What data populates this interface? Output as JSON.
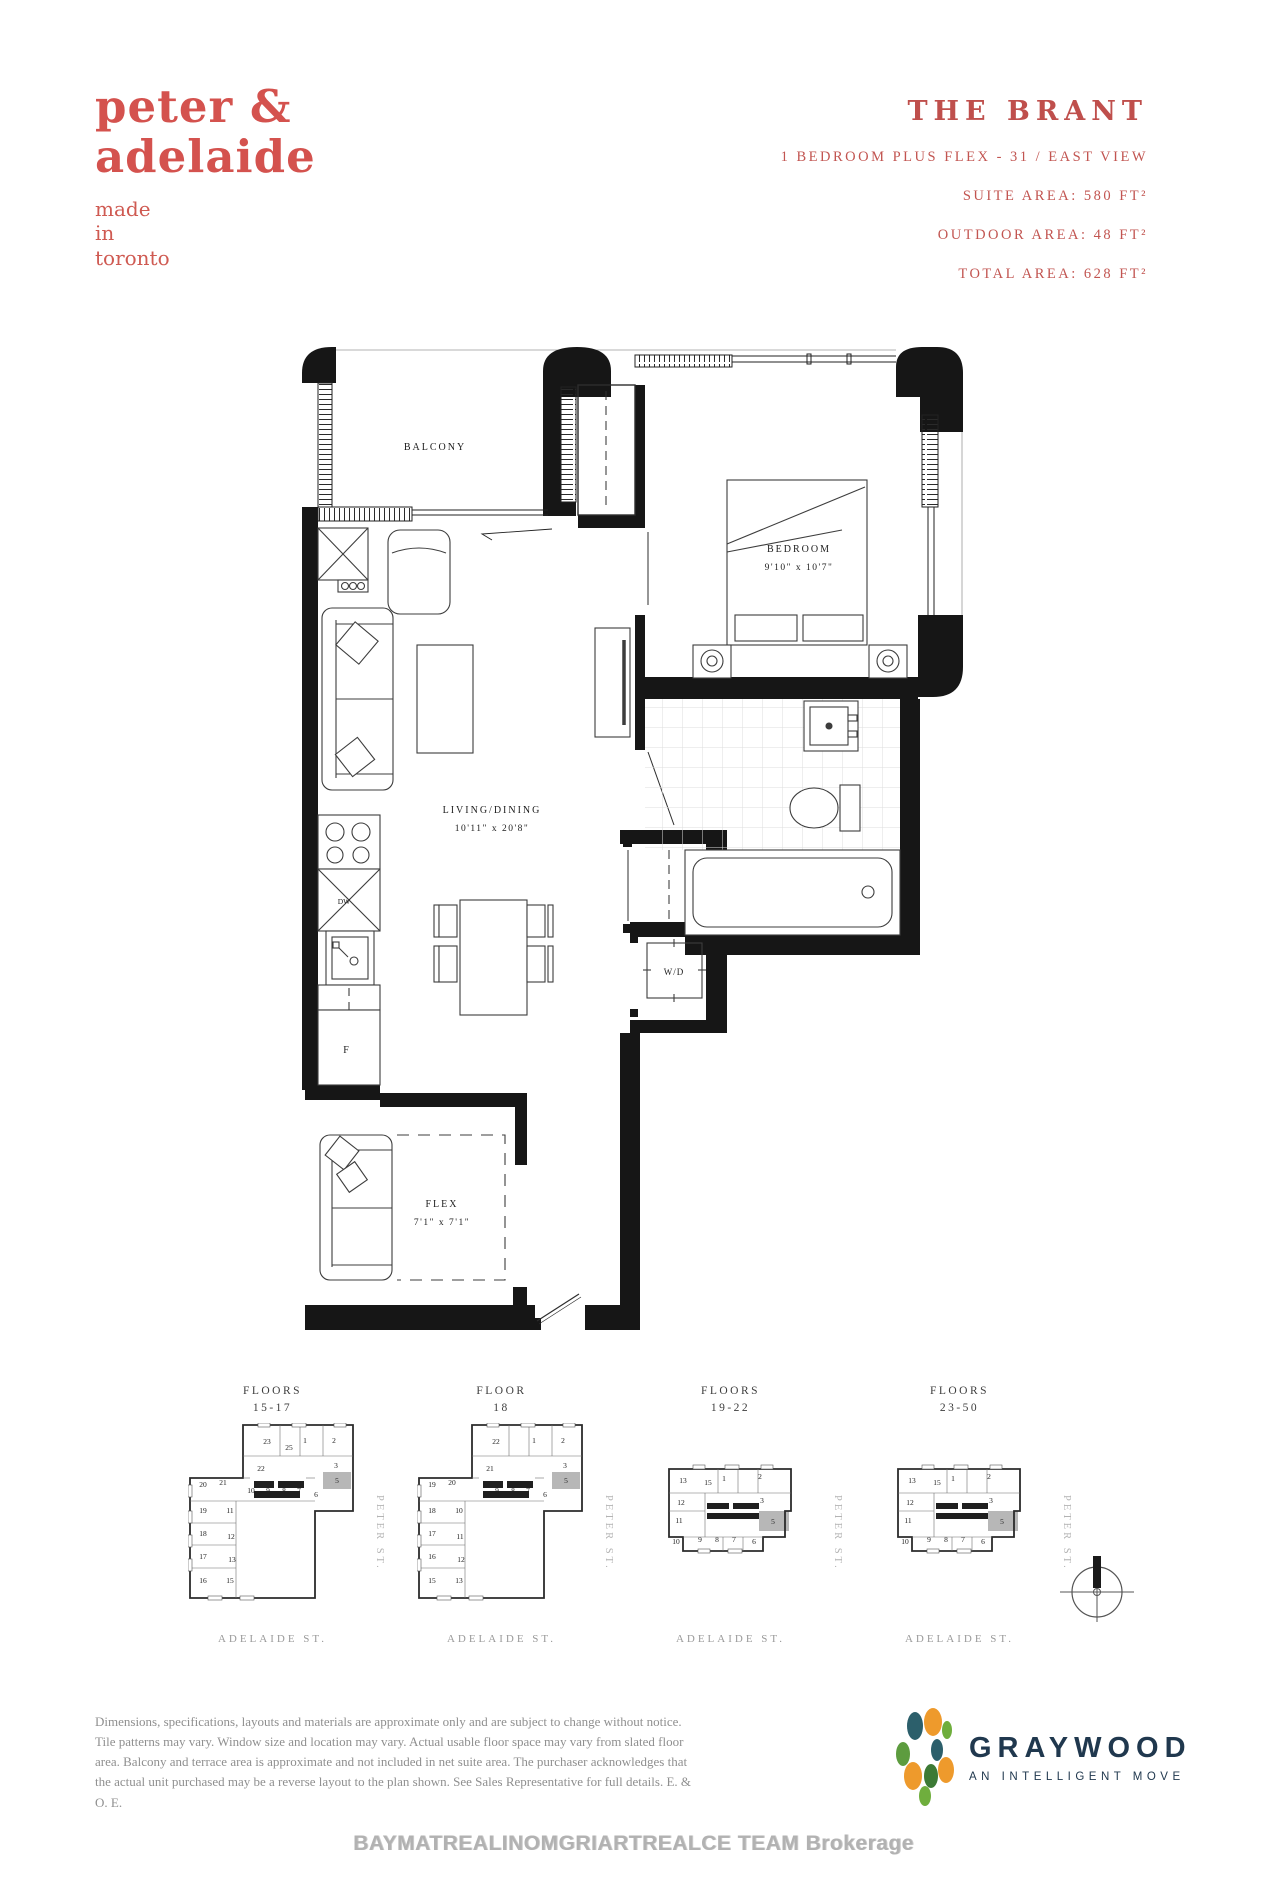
{
  "brand": {
    "logo_line1": "peter &",
    "logo_line2": "adelaide",
    "tagline_lines": [
      "made",
      "in",
      "toronto"
    ]
  },
  "header": {
    "title": "THE BRANT",
    "subtitle": "1 BEDROOM PLUS FLEX - 31 / EAST VIEW",
    "suite_area": "SUITE AREA: 580 FT²",
    "outdoor_area": "OUTDOOR AREA: 48 FT²",
    "total_area": "TOTAL AREA: 628 FT²"
  },
  "floorplan": {
    "labels": {
      "balcony": "BALCONY",
      "bedroom_name": "BEDROOM",
      "bedroom_dims": "9'10\" x 10'7\"",
      "living_name": "LIVING/DINING",
      "living_dims": "10'11\" x 20'8\"",
      "flex_name": "FLEX",
      "flex_dims": "7'1\" x 7'1\"",
      "wd": "W/D",
      "fridge": "F",
      "dishwasher": "DW"
    }
  },
  "key_plans": [
    {
      "title": [
        "FLOORS",
        "15-17"
      ],
      "shape": "L1",
      "street_right": "PETER ST.",
      "street_bottom": "ADELAIDE ST.",
      "highlighted_unit": "5",
      "units": [
        "23",
        "25",
        "1",
        "2",
        "22",
        "3",
        "20",
        "21",
        "10",
        "9",
        "8",
        "7",
        "6",
        "5",
        "19",
        "11",
        "18",
        "12",
        "17",
        "13",
        "16",
        "15"
      ]
    },
    {
      "title": [
        "FLOOR",
        "18"
      ],
      "shape": "L2",
      "street_right": "PETER ST.",
      "street_bottom": "ADELAIDE ST.",
      "highlighted_unit": "5",
      "units": [
        "22",
        "1",
        "2",
        "21",
        "3",
        "19",
        "20",
        "9",
        "8",
        "7",
        "6",
        "5",
        "18",
        "10",
        "17",
        "11",
        "16",
        "12",
        "15",
        "13"
      ]
    },
    {
      "title": [
        "FLOORS",
        "19-22"
      ],
      "shape": "B",
      "street_right": "PETER ST.",
      "street_bottom": "ADELAIDE ST.",
      "highlighted_unit": "5",
      "units": [
        "13",
        "15",
        "1",
        "2",
        "12",
        "3",
        "11",
        "5",
        "10",
        "9",
        "8",
        "7",
        "6"
      ]
    },
    {
      "title": [
        "FLOORS",
        "23-50"
      ],
      "shape": "B",
      "street_right": "PETER ST.",
      "street_bottom": "ADELAIDE ST.",
      "highlighted_unit": "5",
      "units": [
        "13",
        "15",
        "1",
        "2",
        "12",
        "3",
        "11",
        "5",
        "10",
        "9",
        "8",
        "7",
        "6"
      ]
    }
  ],
  "footer": {
    "disclaimer": "Dimensions, specifications, layouts and materials are approximate only and are subject to change without notice. Tile patterns may vary. Window size and location may vary. Actual usable floor space may vary from slated floor area. Balcony and terrace area is approximate and not included in net suite area. The purchaser acknowledges that the actual unit purchased may be a reverse layout to the plan shown.  See Sales Representative for full details. E. & O. E.",
    "watermark": "BAYMATREALINOMGRIARTREALCE TEAM Brokerage",
    "logo_name": "GRAYWOOD",
    "logo_tagline": "AN INTELLIGENT MOVE"
  },
  "colors": {
    "brand_red": "#d4524e",
    "header_red": "#bf4f4c",
    "highlight_gray": "#b7b7b7",
    "graywood_navy": "#20384e"
  }
}
